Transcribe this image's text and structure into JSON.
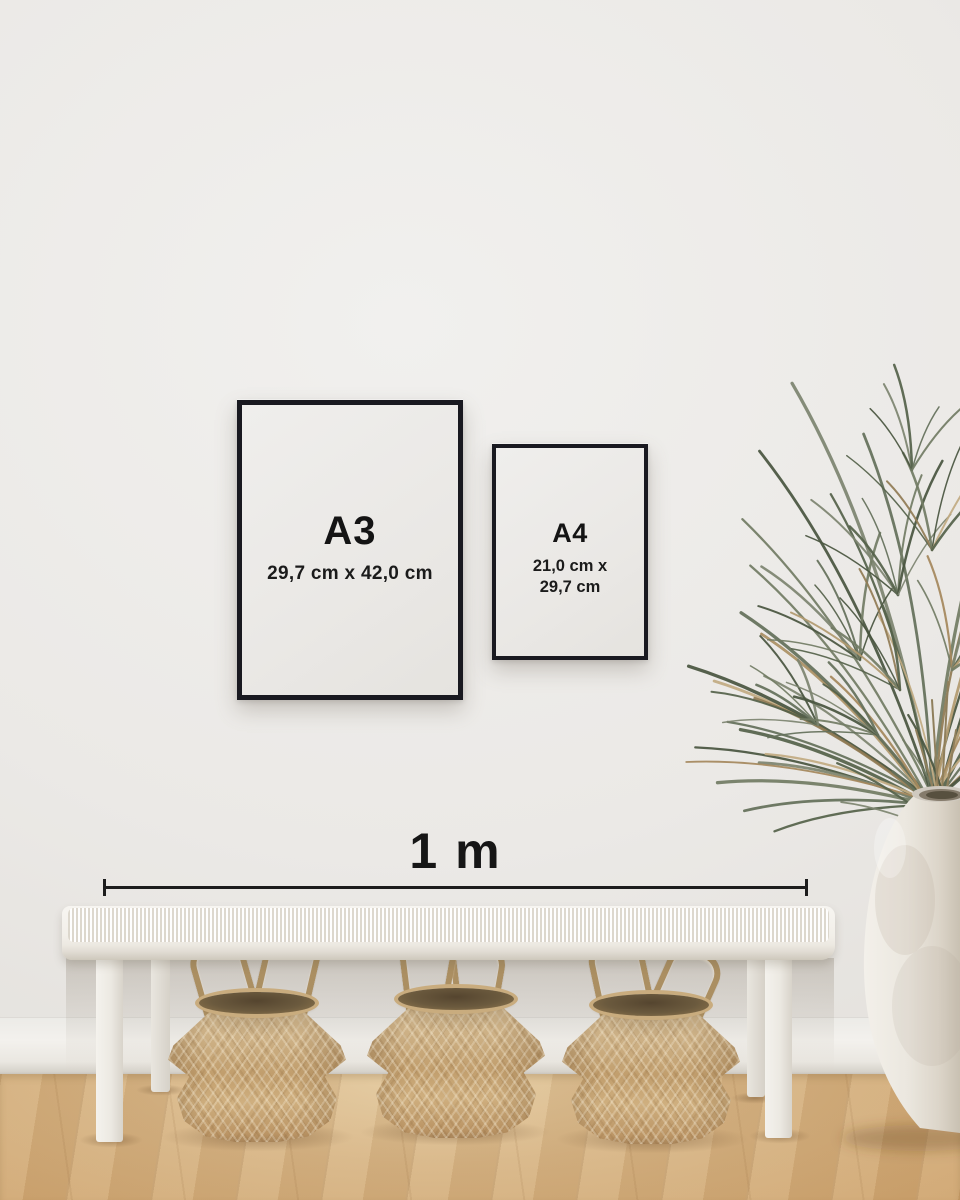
{
  "frames": {
    "a3": {
      "label": "A3",
      "dimensions": "29,7 cm x 42,0 cm"
    },
    "a4": {
      "label": "A4",
      "dimensions_line1": "21,0 cm x",
      "dimensions_line2": "29,7 cm"
    }
  },
  "measure": {
    "label": "1 m"
  },
  "palette": {
    "frame_border": "#191920",
    "frame_paper": "#ecebe8",
    "text": "#141414",
    "measure_line": "#1d1d1d",
    "wall": "#ebe9e6",
    "baseboard": "#f3f1ed",
    "floor_wood": "#d6b383",
    "bench_white": "#f2efe9",
    "basket_tan": "#c4a171",
    "basket_rope": "#ab8f62",
    "vase_white": "#ece8e1",
    "plant_greens": [
      "#55624a",
      "#64705a",
      "#727c64",
      "#49553f",
      "#7d8470"
    ],
    "plant_tans": [
      "#b29a6f",
      "#a5885c",
      "#c2ab82",
      "#917c55"
    ]
  }
}
